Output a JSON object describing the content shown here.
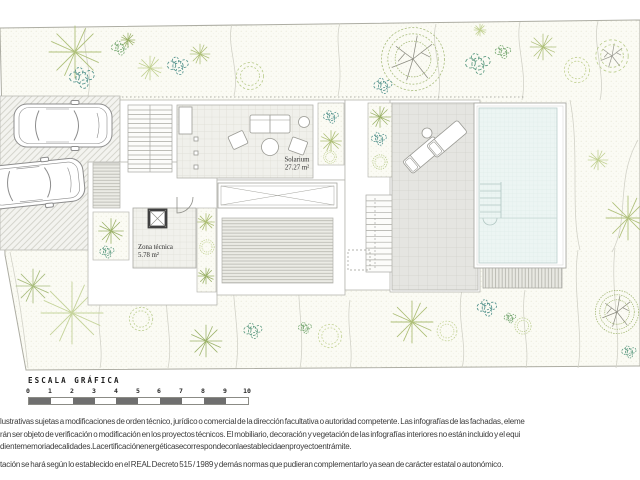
{
  "plan": {
    "solarium": {
      "name": "Solarium",
      "area": "27.27 m²"
    },
    "zona_tecnica": {
      "name": "Zona técnica",
      "area": "5.78 m²"
    }
  },
  "scale_bar": {
    "title": "ESCALA GRÁFICA",
    "ticks": [
      "0",
      "1",
      "2",
      "3",
      "4",
      "5",
      "6",
      "7",
      "8",
      "9",
      "10"
    ]
  },
  "disclaimer": {
    "line1": "lustrativas sujetas a modificaciones de orden técnico, jurídico o comercial de la dirección facultativa o autoridad competente. Las infografías de las fachadas, eleme",
    "line2": "rán ser objeto de verificación o modificación en los proyectos técnicos. El mobiliario, decoración y vegetación de las infografías interiores no están incluido y el equi",
    "line3": "diente memoria de calidades. La certificación energética se corresponde con la establecida en proyecto en trámite.",
    "line4": "tación se hará según lo establecido en el REAL Decreto 515 / 1989 y demás normas que pudieran complementarlo ya sean de carácter estatal o autonómico."
  },
  "colors": {
    "pool_water": "#ecf5f3",
    "vegetation_green": "#9db36b",
    "vegetation_teal": "#4f908a",
    "scale_fill": "#6f6f6f"
  }
}
